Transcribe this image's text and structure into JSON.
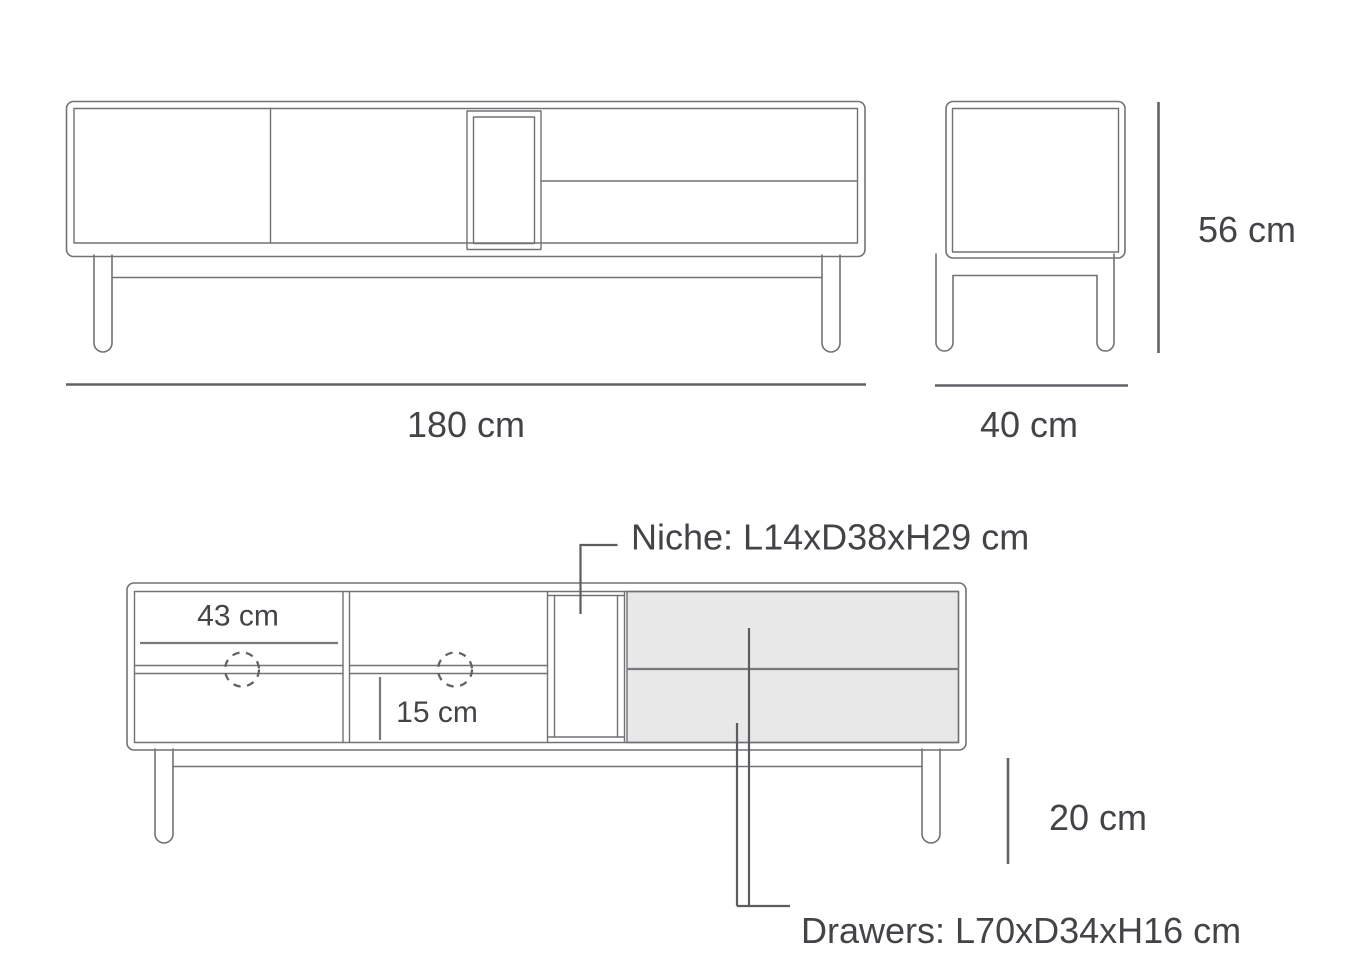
{
  "diagram": {
    "front_view": {
      "length_label": "180 cm",
      "height_label": "56 cm"
    },
    "side_view": {
      "depth_label": "40 cm"
    },
    "interior_view": {
      "shelf_width_label": "43 cm",
      "lower_compartment_height_label": "15 cm",
      "leg_height_label": "20 cm",
      "niche_label": "Niche: L14xD38xH29 cm",
      "drawers_label": "Drawers: L70xD34xH16 cm"
    },
    "colors": {
      "outline": "#707276",
      "dimension_line": "#606266",
      "text": "#424448",
      "drawer_fill": "#e8e8e8",
      "background": "#ffffff"
    }
  }
}
